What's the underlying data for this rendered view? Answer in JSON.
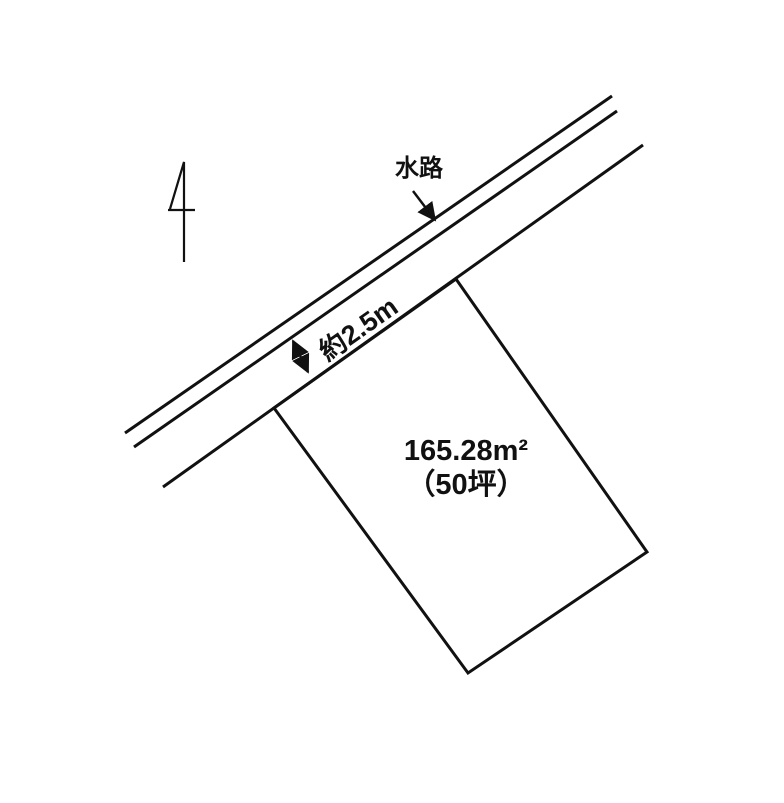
{
  "plan": {
    "background_color": "#ffffff",
    "line_color": "#111111",
    "north_arrow_icon": "north-arrow",
    "labels": {
      "waterway": "水路",
      "road_width": "約2.5m",
      "area_sqm": "165.28m²",
      "area_tsubo": "（50坪）"
    }
  }
}
